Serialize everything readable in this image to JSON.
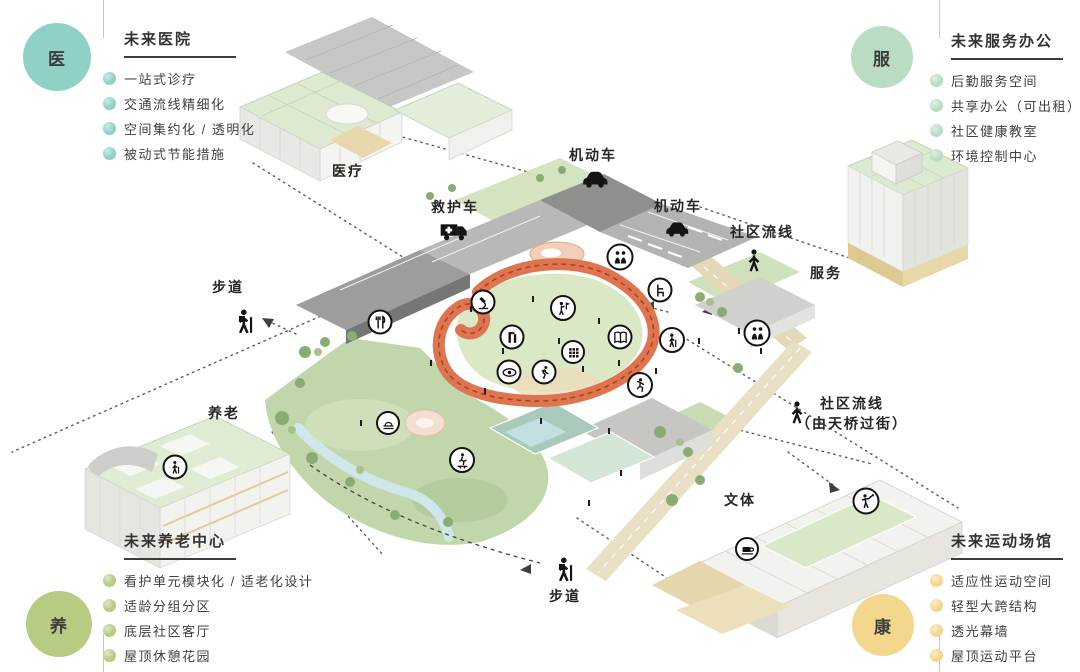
{
  "palette": {
    "medical_teal": "#8fd1c5",
    "service_green": "#b9dcc3",
    "elderly_olive": "#b7cb82",
    "sport_yellow": "#f3d78c",
    "track_orange": "#df7450"
  },
  "corners": {
    "top_left": {
      "badge": "医",
      "color": "#8fd1c5",
      "title": "未来医院",
      "items": [
        "一站式诊疗",
        "交通流线精细化",
        "空间集约化 / 透明化",
        "被动式节能措施"
      ]
    },
    "top_right": {
      "badge": "服",
      "color": "#b9dcc3",
      "title": "未来服务办公",
      "items": [
        "后勤服务空间",
        "共享办公（可出租）",
        "社区健康教室",
        "环境控制中心"
      ]
    },
    "bottom_left": {
      "badge": "养",
      "color": "#b7cb82",
      "title": "未来养老中心",
      "items": [
        "看护单元模块化 / 适老化设计",
        "适龄分组分区",
        "底层社区客厅",
        "屋顶休憩花园"
      ]
    },
    "bottom_right": {
      "badge": "康",
      "color": "#f3d78c",
      "title": "未来运动场馆",
      "items": [
        "适应性运动空间",
        "轻型大跨结构",
        "透光幕墙",
        "屋顶运动平台"
      ]
    }
  },
  "scene": {
    "labels": [
      {
        "name": "label-medical",
        "text": "医疗",
        "x": 348,
        "y": 172
      },
      {
        "name": "label-motor-vehicle-top",
        "text": "机动车",
        "x": 593,
        "y": 156
      },
      {
        "name": "label-ambulance",
        "text": "救护车",
        "x": 455,
        "y": 208
      },
      {
        "name": "label-motor-vehicle-right",
        "text": "机动车",
        "x": 678,
        "y": 207
      },
      {
        "name": "label-community-flow",
        "text": "社区流线",
        "x": 762,
        "y": 233
      },
      {
        "name": "label-service",
        "text": "服务",
        "x": 826,
        "y": 274
      },
      {
        "name": "label-footpath-left",
        "text": "步道",
        "x": 228,
        "y": 288
      },
      {
        "name": "label-elderly-care",
        "text": "养老",
        "x": 224,
        "y": 414
      },
      {
        "name": "label-community-flow-bridge",
        "lines": [
          "社区流线",
          "（由天桥过街）"
        ],
        "x": 852,
        "y": 414
      },
      {
        "name": "label-culture-sports",
        "text": "文体",
        "x": 740,
        "y": 501
      },
      {
        "name": "label-footpath-bottom",
        "text": "步道",
        "x": 565,
        "y": 597
      }
    ],
    "glyphs": [
      {
        "name": "car-icon",
        "icon": "car",
        "x": 595,
        "y": 178,
        "size": 30
      },
      {
        "name": "ambulance-icon",
        "icon": "ambulance",
        "x": 454,
        "y": 229,
        "size": 32
      },
      {
        "name": "car-icon",
        "icon": "car",
        "x": 677,
        "y": 228,
        "size": 27
      },
      {
        "name": "walking-person-icon",
        "icon": "walker",
        "x": 754,
        "y": 261,
        "size": 27
      },
      {
        "name": "hiker-icon",
        "icon": "hiker",
        "x": 245,
        "y": 322,
        "size": 29
      },
      {
        "name": "walking-person-icon",
        "icon": "walker",
        "x": 797,
        "y": 413,
        "size": 27
      },
      {
        "name": "hiker-icon",
        "icon": "hiker",
        "x": 565,
        "y": 570,
        "size": 29
      }
    ],
    "markers": [
      {
        "name": "dining-icon",
        "icon": "fork",
        "x": 380,
        "y": 322,
        "size": 25
      },
      {
        "name": "microscope-icon",
        "icon": "scope",
        "x": 483,
        "y": 302,
        "size": 25
      },
      {
        "name": "flag-person-icon",
        "icon": "flagperson",
        "x": 563,
        "y": 308,
        "size": 26
      },
      {
        "name": "fitness-icon",
        "icon": "gym",
        "x": 512,
        "y": 337,
        "size": 25
      },
      {
        "name": "book-icon",
        "icon": "book",
        "x": 620,
        "y": 337,
        "size": 25
      },
      {
        "name": "game-grid-icon",
        "icon": "grid",
        "x": 573,
        "y": 352,
        "size": 24
      },
      {
        "name": "eye-icon",
        "icon": "eye",
        "x": 509,
        "y": 372,
        "size": 25
      },
      {
        "name": "runner-icon",
        "icon": "runner",
        "x": 544,
        "y": 372,
        "size": 25
      },
      {
        "name": "reception-icon",
        "icon": "people",
        "x": 620,
        "y": 257,
        "size": 27
      },
      {
        "name": "chair-icon",
        "icon": "chair",
        "x": 660,
        "y": 290,
        "size": 25
      },
      {
        "name": "elderly-cane-icon",
        "icon": "cane",
        "x": 672,
        "y": 340,
        "size": 26
      },
      {
        "name": "reception-icon",
        "icon": "people",
        "x": 757,
        "y": 333,
        "size": 27
      },
      {
        "name": "dancer-icon",
        "icon": "dancer",
        "x": 640,
        "y": 385,
        "size": 26
      },
      {
        "name": "amphitheater-icon",
        "icon": "stage",
        "x": 388,
        "y": 423,
        "size": 24
      },
      {
        "name": "skater-icon",
        "icon": "skater",
        "x": 462,
        "y": 460,
        "size": 26
      },
      {
        "name": "elderly-cane-icon",
        "icon": "cane",
        "x": 175,
        "y": 467,
        "size": 25
      },
      {
        "name": "table-tennis-icon",
        "icon": "tennis",
        "x": 866,
        "y": 501,
        "size": 27
      },
      {
        "name": "coffee-icon",
        "icon": "cup",
        "x": 747,
        "y": 549,
        "size": 24
      }
    ]
  }
}
